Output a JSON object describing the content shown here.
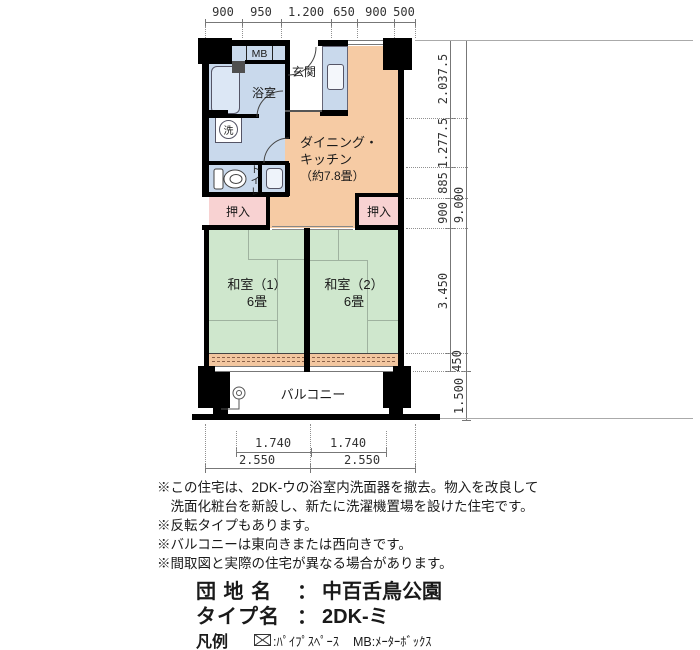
{
  "plan": {
    "rooms": {
      "mb": "MB",
      "bathroom": "浴室",
      "washer": "洗",
      "toilet": "トイレ",
      "entrance": "玄関",
      "dk": {
        "line1": "ダイニング・",
        "line2": "キッチン",
        "line3": "（約7.8畳）"
      },
      "closet_left": "押入",
      "closet_right": "押入",
      "washitsu1": {
        "name": "和室（1）",
        "size": "6畳"
      },
      "washitsu2": {
        "name": "和室（2）",
        "size": "6畳"
      },
      "balcony": "バルコニー"
    },
    "dims": {
      "top": [
        "900",
        "950",
        "1.200",
        "650",
        "900",
        "500"
      ],
      "right_inner": [
        "2.037.5",
        "1.277.5",
        "885",
        "900",
        "3.450",
        "450"
      ],
      "right_outer": [
        "9.000",
        "1.500"
      ],
      "bottom_inner": [
        "1.740",
        "1.740"
      ],
      "bottom_outer": [
        "2.550",
        "2.550"
      ]
    }
  },
  "notes": [
    "※この住宅は、2DK-ウの浴室内洗面器を撤去。物入を改良して",
    "　洗面化粧台を新設し、新たに洗濯機置場を設けた住宅です。",
    "※反転タイプもあります。",
    "※バルコニーは東向きまたは西向きです。",
    "※間取図と実際の住宅が異なる場合があります。"
  ],
  "estate": {
    "label": "団 地 名",
    "colon": "：",
    "value": "中百舌鳥公園"
  },
  "unit_type": {
    "label": "タイプ名",
    "colon": "：",
    "value": "2DK-ミ"
  },
  "legend": {
    "title": "凡例",
    "pipe": ":ﾊﾟｲﾌﾟｽﾍﾟｰｽ",
    "mb": "MB:ﾒｰﾀｰﾎﾞｯｸｽ"
  },
  "colors": {
    "wall": "#000000",
    "water_area": "#c9d9ec",
    "dining_kitchen": "#f6cba4",
    "tatami": "#cfe7cd",
    "closet": "#f8d2d2",
    "engawa": "#f2c69f"
  }
}
